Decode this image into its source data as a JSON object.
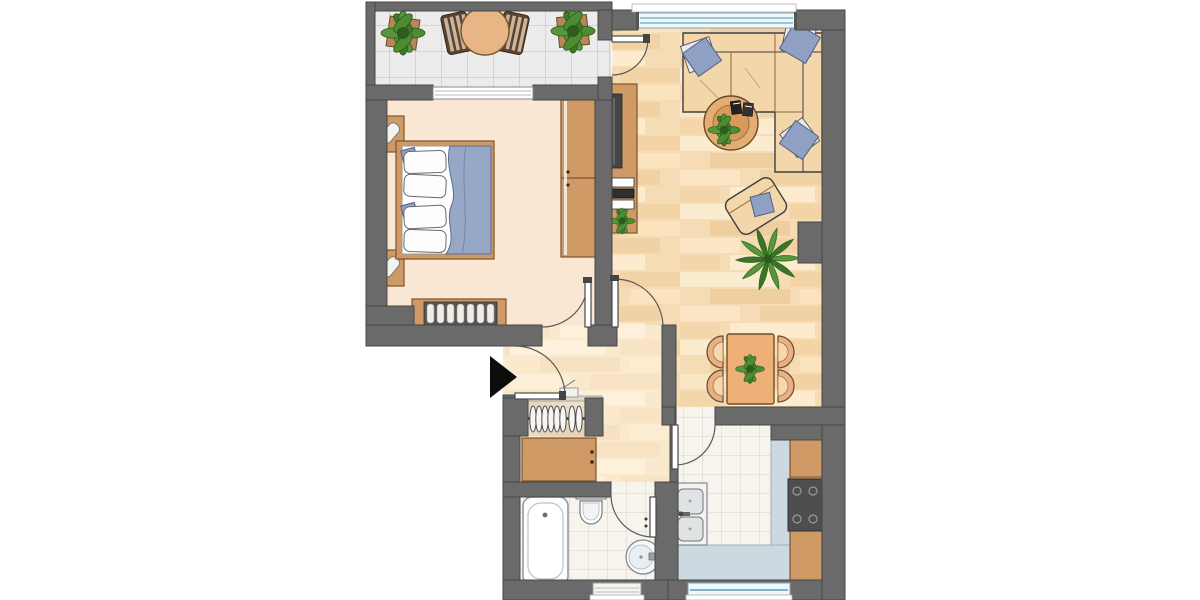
{
  "image": {
    "type": "floor-plan",
    "description": "Top-down unlabeled floor plan of a one-bedroom apartment with balcony, bedroom, living-dining room, hallway, bathroom and kitchen",
    "text_labels": []
  },
  "palette": {
    "wall": "#6a6a6a",
    "wallEdge": "#474747",
    "bedroomFloor": "#f9e7d3",
    "woodFloor": "#f6dcb4",
    "hallTint": "rgba(255,248,235,0.45)",
    "tileFloor": "#f7f4ed",
    "tileLine": "#d8d2c6",
    "balconyTile": "#ececec",
    "balconyTileLine": "#bdbdbd",
    "furnitureTan": "#d09a66",
    "furnitureEdge": "#7a552e",
    "sofa": "#f4d6ab",
    "cushionBlue": "#8fa0c2",
    "blueDark": "#51618c",
    "blanketBlue": "#97a8c7",
    "tableOrange": "#efb077",
    "counterBlue": "#ccd9e0",
    "stoveGray": "#4e4e4e",
    "plantGreen": "#4e8c33",
    "plantDark": "#2e5c1d",
    "fixtureWhite": "#fbfdfe",
    "glassBlue": "#7fb3c8",
    "chairBrown": "#5c432f",
    "arrowBlack": "#0d0d0d"
  },
  "rooms": [
    {
      "id": "balcony",
      "name": "Balcony",
      "floor": "tiles",
      "furniture": [
        "potted plant left",
        "round table",
        "chair left",
        "chair right",
        "potted plant right"
      ]
    },
    {
      "id": "bedroom",
      "name": "Bedroom",
      "floor": "carpet-cream",
      "furniture": [
        "double bed with blue duvet and two pillow pairs",
        "nightstand with lamp (top)",
        "nightstand with lamp (bottom)",
        "two-part wardrobe",
        "slatted sideboard"
      ]
    },
    {
      "id": "living-room",
      "name": "Living / dining room",
      "floor": "wood",
      "furniture": [
        "corner sofa with three blue cushions",
        "round coffee table with plant and books",
        "armchair with blue cushion",
        "media sideboard with TV and hifi and plant",
        "palm plant",
        "dining table with plant",
        "four dining chairs"
      ]
    },
    {
      "id": "hallway",
      "name": "Hallway",
      "floor": "wood",
      "furniture": [
        "coat rack with hangers",
        "wardrobe"
      ]
    },
    {
      "id": "bathroom",
      "name": "Bathroom",
      "floor": "tiles",
      "furniture": [
        "bathtub",
        "toilet",
        "round washbasin"
      ]
    },
    {
      "id": "kitchen",
      "name": "Kitchen",
      "floor": "tiles",
      "furniture": [
        "double-basin sink unit",
        "bottom counter",
        "side counter",
        "stove-oven",
        "cabinets"
      ]
    }
  ],
  "doors": [
    "balcony door",
    "bedroom door",
    "living-room door",
    "bathroom door",
    "kitchen door",
    "entrance door"
  ],
  "windows": [
    "balcony-bedroom window",
    "living-room window",
    "bathroom window",
    "kitchen window"
  ],
  "entrance": {
    "marker": "black triangle arrow",
    "direction": "pointing right into flat"
  }
}
